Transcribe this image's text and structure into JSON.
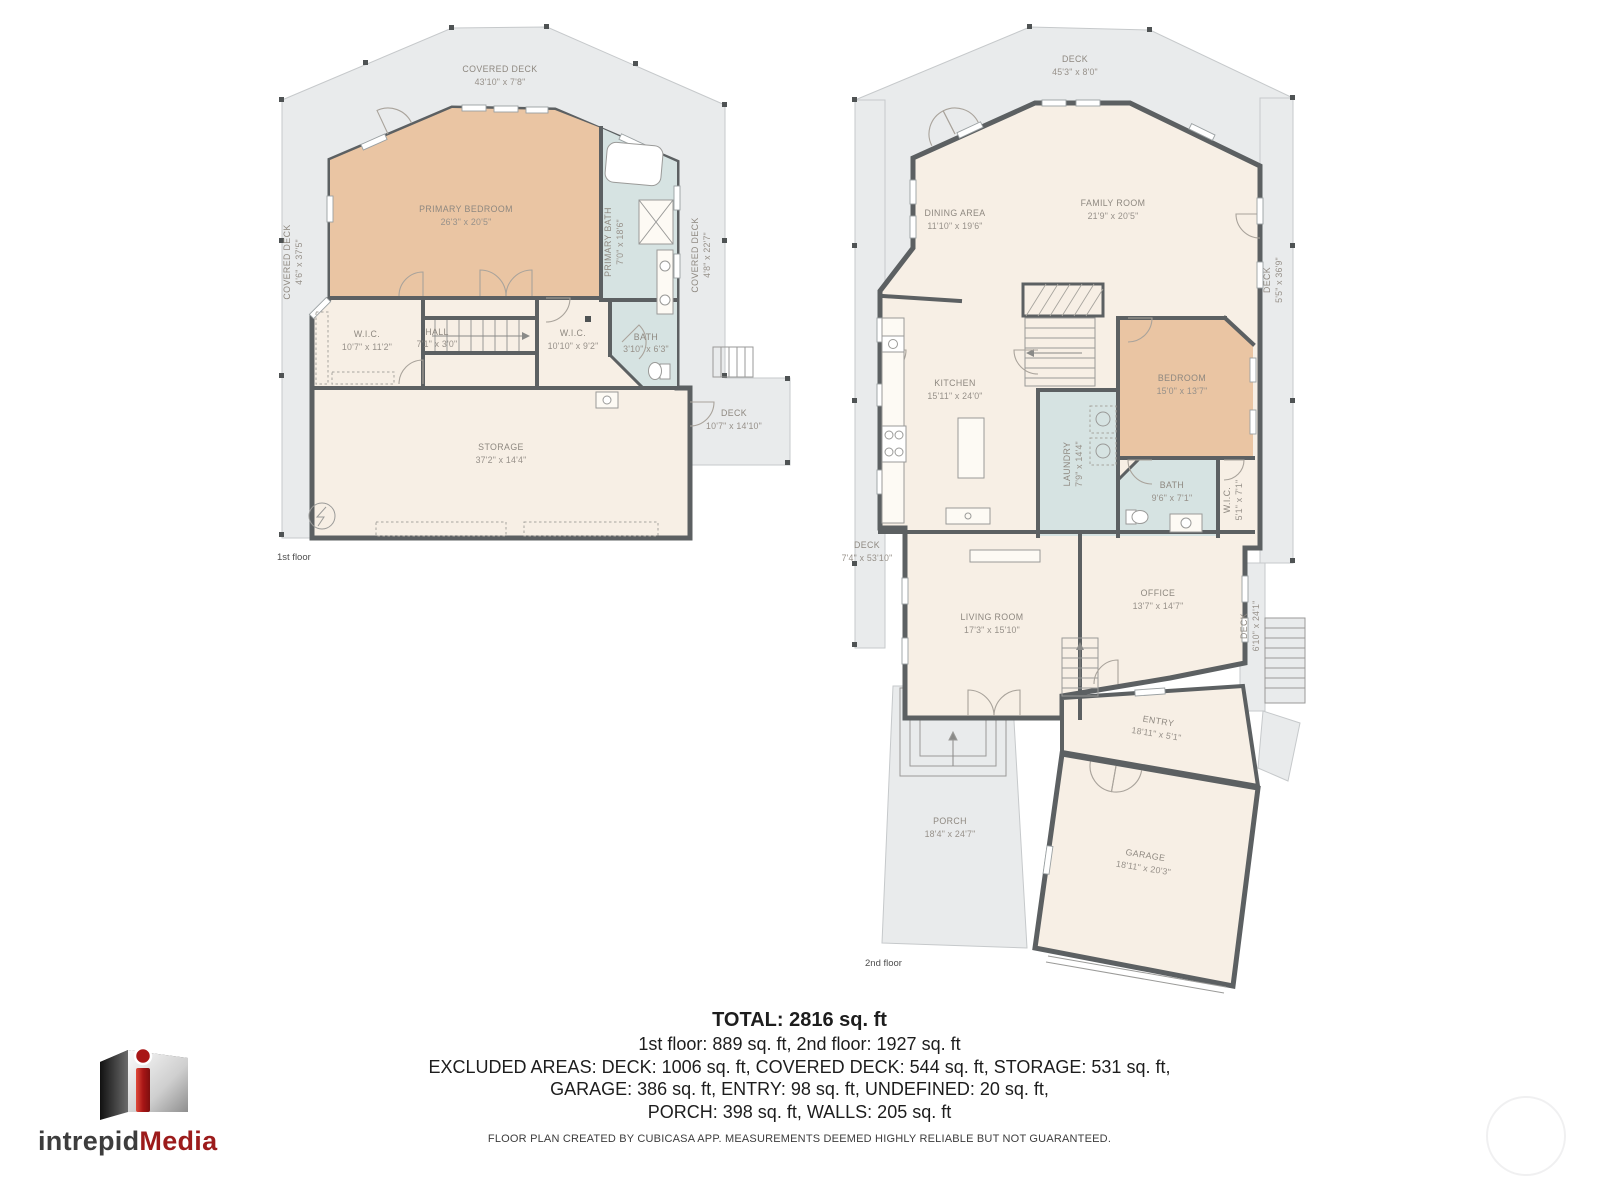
{
  "floor1": {
    "label": "1st floor",
    "covered_deck_top": {
      "label": "COVERED DECK",
      "dims": "43'10\" x 7'8\""
    },
    "covered_deck_left": {
      "label": "COVERED DECK",
      "dims": "4'6\" x 37'5\""
    },
    "covered_deck_right": {
      "label": "COVERED DECK",
      "dims": "4'8\" x 22'7\""
    },
    "primary_bedroom": {
      "label": "PRIMARY BEDROOM",
      "dims": "26'3\" x 20'5\""
    },
    "primary_bath": {
      "label": "PRIMARY BATH",
      "dims": "7'0\" x 18'6\""
    },
    "wic_left": {
      "label": "W.I.C.",
      "dims": "10'7\" x 11'2\""
    },
    "hall": {
      "label": "HALL",
      "dims": "7'1\" x 3'0\""
    },
    "wic_right": {
      "label": "W.I.C.",
      "dims": "10'10\" x 9'2\""
    },
    "bath": {
      "label": "BATH",
      "dims": "3'10\" x 6'3\""
    },
    "storage": {
      "label": "STORAGE",
      "dims": "37'2\" x 14'4\""
    },
    "deck_right": {
      "label": "DECK",
      "dims": "10'7\" x 14'10\""
    }
  },
  "floor2": {
    "label": "2nd floor",
    "deck_top": {
      "label": "DECK",
      "dims": "45'3\" x 8'0\""
    },
    "dining": {
      "label": "DINING AREA",
      "dims": "11'10\" x 19'6\""
    },
    "family": {
      "label": "FAMILY ROOM",
      "dims": "21'9\" x 20'5\""
    },
    "deck_right": {
      "label": "DECK",
      "dims": "5'5\" x 36'9\""
    },
    "kitchen": {
      "label": "KITCHEN",
      "dims": "15'11\" x 24'0\""
    },
    "laundry": {
      "label": "LAUNDRY",
      "dims": "7'9\" x 14'4\""
    },
    "bedroom": {
      "label": "BEDROOM",
      "dims": "15'0\" x 13'7\""
    },
    "bath": {
      "label": "BATH",
      "dims": "9'6\" x 7'1\""
    },
    "wic": {
      "label": "W.I.C.",
      "dims": "5'1\" x 7'1\""
    },
    "deck_left": {
      "label": "DECK",
      "dims": "7'4\" x 53'10\""
    },
    "living": {
      "label": "LIVING ROOM",
      "dims": "17'3\" x 15'10\""
    },
    "office": {
      "label": "OFFICE",
      "dims": "13'7\" x 14'7\""
    },
    "deck_lower_right": {
      "label": "DECK",
      "dims": "6'10\" x 24'1\""
    },
    "entry": {
      "label": "ENTRY",
      "dims": "18'11\" x 5'1\""
    },
    "porch": {
      "label": "PORCH",
      "dims": "18'4\" x 24'7\""
    },
    "garage": {
      "label": "GARAGE",
      "dims": "18'11\" x 20'3\""
    }
  },
  "summary": {
    "total": "TOTAL: 2816 sq. ft",
    "line1": "1st floor: 889 sq. ft, 2nd floor: 1927 sq. ft",
    "line2": "EXCLUDED AREAS: DECK: 1006 sq. ft, COVERED DECK: 544 sq. ft, STORAGE: 531 sq. ft,",
    "line3": "GARAGE: 386 sq. ft, ENTRY: 98 sq. ft, UNDEFINED: 20 sq. ft,",
    "line4": "PORCH: 398 sq. ft, WALLS: 205 sq. ft"
  },
  "disclaimer": "FLOOR PLAN CREATED BY CUBICASA APP. MEASUREMENTS DEEMED HIGHLY RELIABLE BUT NOT GUARANTEED.",
  "logo": {
    "word1": "intrepid",
    "word2": "Media"
  },
  "colors": {
    "room": "#f7efe5",
    "accent_room": "#eac5a3",
    "wet_room": "#d6e3e2",
    "deck": "#e9ebec",
    "wall": "#5c6062",
    "label_text": "#8e8880",
    "brand_red": "#9c1b1b"
  }
}
